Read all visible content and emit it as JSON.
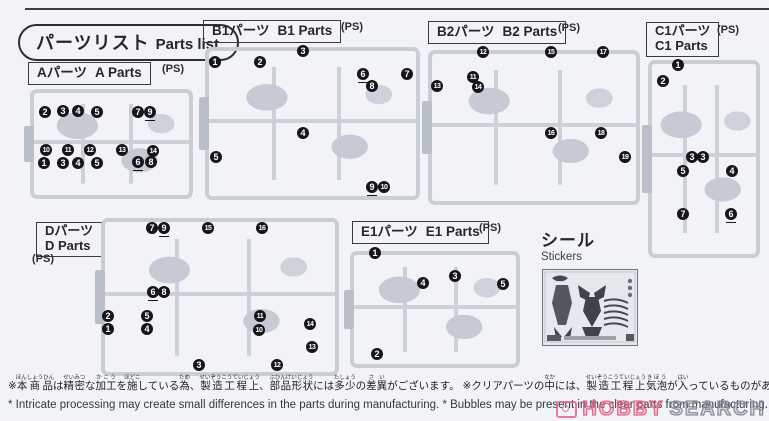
{
  "header": {
    "title_jp": "パーツリスト",
    "title_en": "Parts list"
  },
  "sections": [
    {
      "id": "A",
      "label_jp": "Aパーツ",
      "label_en": "A Parts",
      "ps": "(PS)",
      "two_line": false,
      "label_pos": {
        "x": 28,
        "y": 62
      },
      "ps_pos": {
        "x": 162,
        "y": 63
      },
      "runner": {
        "x": 30,
        "y": 89,
        "w": 163,
        "h": 110
      },
      "badges": [
        {
          "n": 2,
          "x": 45,
          "y": 112
        },
        {
          "n": 3,
          "x": 63,
          "y": 111
        },
        {
          "n": 4,
          "x": 78,
          "y": 111
        },
        {
          "n": 5,
          "x": 97,
          "y": 112
        },
        {
          "n": 7,
          "x": 138,
          "y": 112
        },
        {
          "n": 9,
          "x": 150,
          "y": 112,
          "u": true
        },
        {
          "n": 10,
          "x": 46,
          "y": 150
        },
        {
          "n": 11,
          "x": 68,
          "y": 150
        },
        {
          "n": 12,
          "x": 90,
          "y": 150
        },
        {
          "n": 13,
          "x": 122,
          "y": 150
        },
        {
          "n": 14,
          "x": 153,
          "y": 151
        },
        {
          "n": 1,
          "x": 44,
          "y": 163
        },
        {
          "n": 3,
          "x": 63,
          "y": 163
        },
        {
          "n": 4,
          "x": 78,
          "y": 163
        },
        {
          "n": 5,
          "x": 97,
          "y": 163
        },
        {
          "n": 6,
          "x": 138,
          "y": 162,
          "u": true
        },
        {
          "n": 8,
          "x": 151,
          "y": 162
        }
      ]
    },
    {
      "id": "B1",
      "label_jp": "B1パーツ",
      "label_en": "B1 Parts",
      "ps": "(PS)",
      "two_line": false,
      "label_pos": {
        "x": 203,
        "y": 20
      },
      "ps_pos": {
        "x": 341,
        "y": 21
      },
      "runner": {
        "x": 205,
        "y": 47,
        "w": 215,
        "h": 153
      },
      "badges": [
        {
          "n": 1,
          "x": 215,
          "y": 62
        },
        {
          "n": 2,
          "x": 260,
          "y": 62
        },
        {
          "n": 3,
          "x": 303,
          "y": 51
        },
        {
          "n": 6,
          "x": 363,
          "y": 74,
          "u": true
        },
        {
          "n": 7,
          "x": 407,
          "y": 74
        },
        {
          "n": 8,
          "x": 372,
          "y": 86
        },
        {
          "n": 4,
          "x": 303,
          "y": 133
        },
        {
          "n": 5,
          "x": 216,
          "y": 157
        },
        {
          "n": 9,
          "x": 372,
          "y": 187,
          "u": true
        },
        {
          "n": 10,
          "x": 384,
          "y": 187
        }
      ]
    },
    {
      "id": "B2",
      "label_jp": "B2パーツ",
      "label_en": "B2 Parts",
      "ps": "(PS)",
      "two_line": false,
      "label_pos": {
        "x": 428,
        "y": 21
      },
      "ps_pos": {
        "x": 558,
        "y": 22
      },
      "runner": {
        "x": 428,
        "y": 50,
        "w": 212,
        "h": 155
      },
      "badges": [
        {
          "n": 12,
          "x": 483,
          "y": 52
        },
        {
          "n": 15,
          "x": 551,
          "y": 52
        },
        {
          "n": 17,
          "x": 603,
          "y": 52
        },
        {
          "n": 11,
          "x": 473,
          "y": 77
        },
        {
          "n": 13,
          "x": 437,
          "y": 86
        },
        {
          "n": 14,
          "x": 478,
          "y": 87
        },
        {
          "n": 16,
          "x": 551,
          "y": 133
        },
        {
          "n": 18,
          "x": 601,
          "y": 133
        },
        {
          "n": 19,
          "x": 625,
          "y": 157
        }
      ]
    },
    {
      "id": "C1",
      "label_jp": "C1パーツ",
      "label_en": "C1 Parts",
      "ps": "(PS)",
      "two_line": true,
      "label_pos": {
        "x": 646,
        "y": 22
      },
      "ps_pos": {
        "x": 717,
        "y": 24
      },
      "runner": {
        "x": 648,
        "y": 60,
        "w": 112,
        "h": 198
      },
      "badges": [
        {
          "n": 1,
          "x": 678,
          "y": 65
        },
        {
          "n": 2,
          "x": 663,
          "y": 81
        },
        {
          "n": 3,
          "x": 692,
          "y": 157
        },
        {
          "n": 3,
          "x": 703,
          "y": 157
        },
        {
          "n": 5,
          "x": 683,
          "y": 171
        },
        {
          "n": 4,
          "x": 732,
          "y": 171
        },
        {
          "n": 7,
          "x": 683,
          "y": 214
        },
        {
          "n": 6,
          "x": 731,
          "y": 214,
          "u": true
        }
      ]
    },
    {
      "id": "D",
      "label_jp": "Dパーツ",
      "label_en": "D Parts",
      "ps": "(PS)",
      "two_line": true,
      "label_pos": {
        "x": 36,
        "y": 222
      },
      "ps_pos": {
        "x": 32,
        "y": 253
      },
      "runner": {
        "x": 101,
        "y": 218,
        "w": 238,
        "h": 158
      },
      "badges": [
        {
          "n": 7,
          "x": 152,
          "y": 228
        },
        {
          "n": 9,
          "x": 164,
          "y": 228,
          "u": true
        },
        {
          "n": 15,
          "x": 208,
          "y": 228
        },
        {
          "n": 16,
          "x": 262,
          "y": 228
        },
        {
          "n": 6,
          "x": 153,
          "y": 292,
          "u": true
        },
        {
          "n": 8,
          "x": 164,
          "y": 292
        },
        {
          "n": 2,
          "x": 108,
          "y": 316
        },
        {
          "n": 5,
          "x": 147,
          "y": 316
        },
        {
          "n": 11,
          "x": 260,
          "y": 316
        },
        {
          "n": 1,
          "x": 108,
          "y": 329
        },
        {
          "n": 4,
          "x": 147,
          "y": 329
        },
        {
          "n": 10,
          "x": 259,
          "y": 330
        },
        {
          "n": 14,
          "x": 310,
          "y": 324
        },
        {
          "n": 13,
          "x": 312,
          "y": 347
        },
        {
          "n": 3,
          "x": 199,
          "y": 365
        },
        {
          "n": 12,
          "x": 277,
          "y": 365
        }
      ]
    },
    {
      "id": "E1",
      "label_jp": "E1パーツ",
      "label_en": "E1 Parts",
      "ps": "(PS)",
      "two_line": false,
      "label_pos": {
        "x": 352,
        "y": 221
      },
      "ps_pos": {
        "x": 479,
        "y": 222
      },
      "runner": {
        "x": 350,
        "y": 251,
        "w": 170,
        "h": 117
      },
      "badges": [
        {
          "n": 1,
          "x": 375,
          "y": 253
        },
        {
          "n": 4,
          "x": 423,
          "y": 283
        },
        {
          "n": 3,
          "x": 455,
          "y": 276
        },
        {
          "n": 5,
          "x": 503,
          "y": 284
        },
        {
          "n": 2,
          "x": 377,
          "y": 354
        }
      ]
    }
  ],
  "stickers": {
    "label_jp": "シール",
    "label_en": "Stickers"
  },
  "footnotes": {
    "jp": [
      {
        "t": "※"
      },
      {
        "t": "本商品",
        "r": "ほんしょうひん"
      },
      {
        "t": "は"
      },
      {
        "t": "精密",
        "r": "せいみつ"
      },
      {
        "t": "な"
      },
      {
        "t": "加工",
        "r": "かこう"
      },
      {
        "t": "を"
      },
      {
        "t": "施",
        "r": "ほどこ"
      },
      {
        "t": "している"
      },
      {
        "t": "為",
        "r": "ため"
      },
      {
        "t": "、"
      },
      {
        "t": "製造工程上",
        "r": "せいぞうこうていじょう"
      },
      {
        "t": "、"
      },
      {
        "t": "部品形状",
        "r": "ぶひんけいじょう"
      },
      {
        "t": "には"
      },
      {
        "t": "多少",
        "r": "たしょう"
      },
      {
        "t": "の"
      },
      {
        "t": "差異",
        "r": "さい"
      },
      {
        "t": "がございます。 ※クリアパーツの"
      },
      {
        "t": "中",
        "r": "なか"
      },
      {
        "t": "には、"
      },
      {
        "t": "製造工程上",
        "r": "せいぞうこうていじょう"
      },
      {
        "t": "気泡",
        "r": "きほう"
      },
      {
        "t": "が"
      },
      {
        "t": "入",
        "r": "はい"
      },
      {
        "t": "っているものがありますがご"
      },
      {
        "t": "了承",
        "r": "りょうしょう"
      },
      {
        "t": "ください。"
      }
    ],
    "en": "* Intricate processing may create small differences in the parts during manufacturing.  * Bubbles may be present in the clear parts from manufacturing."
  },
  "watermark": {
    "word1": "HOBBY",
    "word2": "SEARCH",
    "accent": "#e05a82"
  },
  "colors": {
    "page_bg": "#f2f3f6",
    "sprue": "#c9cdd6",
    "badge": "#15151a",
    "rule": "#3c3c42"
  }
}
